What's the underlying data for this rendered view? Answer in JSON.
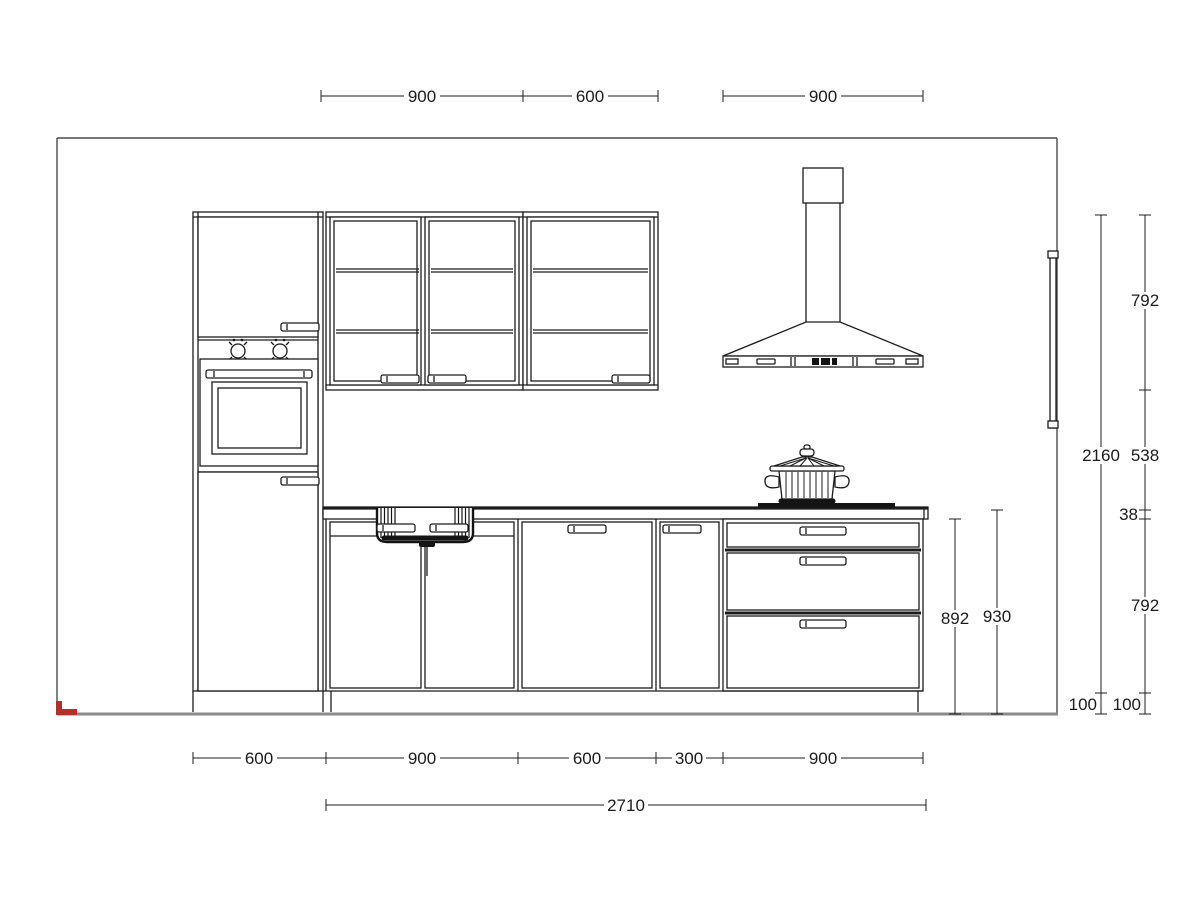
{
  "drawing": {
    "colors": {
      "line": "#1c1c1c",
      "wall": "#4d4d4d",
      "floor": "#8a8a8a",
      "accent_red": "#b23028",
      "background": "#ffffff"
    }
  },
  "dims": {
    "top_wall_cabinet_a": "900",
    "top_wall_cabinet_b": "600",
    "top_hood": "900",
    "right_wall_cabinet_height": "792",
    "right_splashback_gap": "538",
    "right_worktop_thickness": "38",
    "right_base_cabinet_height": "792",
    "right_total_height": "2160",
    "right_plinth_total": "100",
    "right_plinth_segments": "100",
    "mid_base_with_plinth": "892",
    "mid_worktop_level": "930",
    "bottom_tall_unit": "600",
    "bottom_sink_unit": "900",
    "bottom_door_unit": "600",
    "bottom_narrow_unit": "300",
    "bottom_drawer_unit": "900",
    "bottom_run_total": "2710"
  }
}
